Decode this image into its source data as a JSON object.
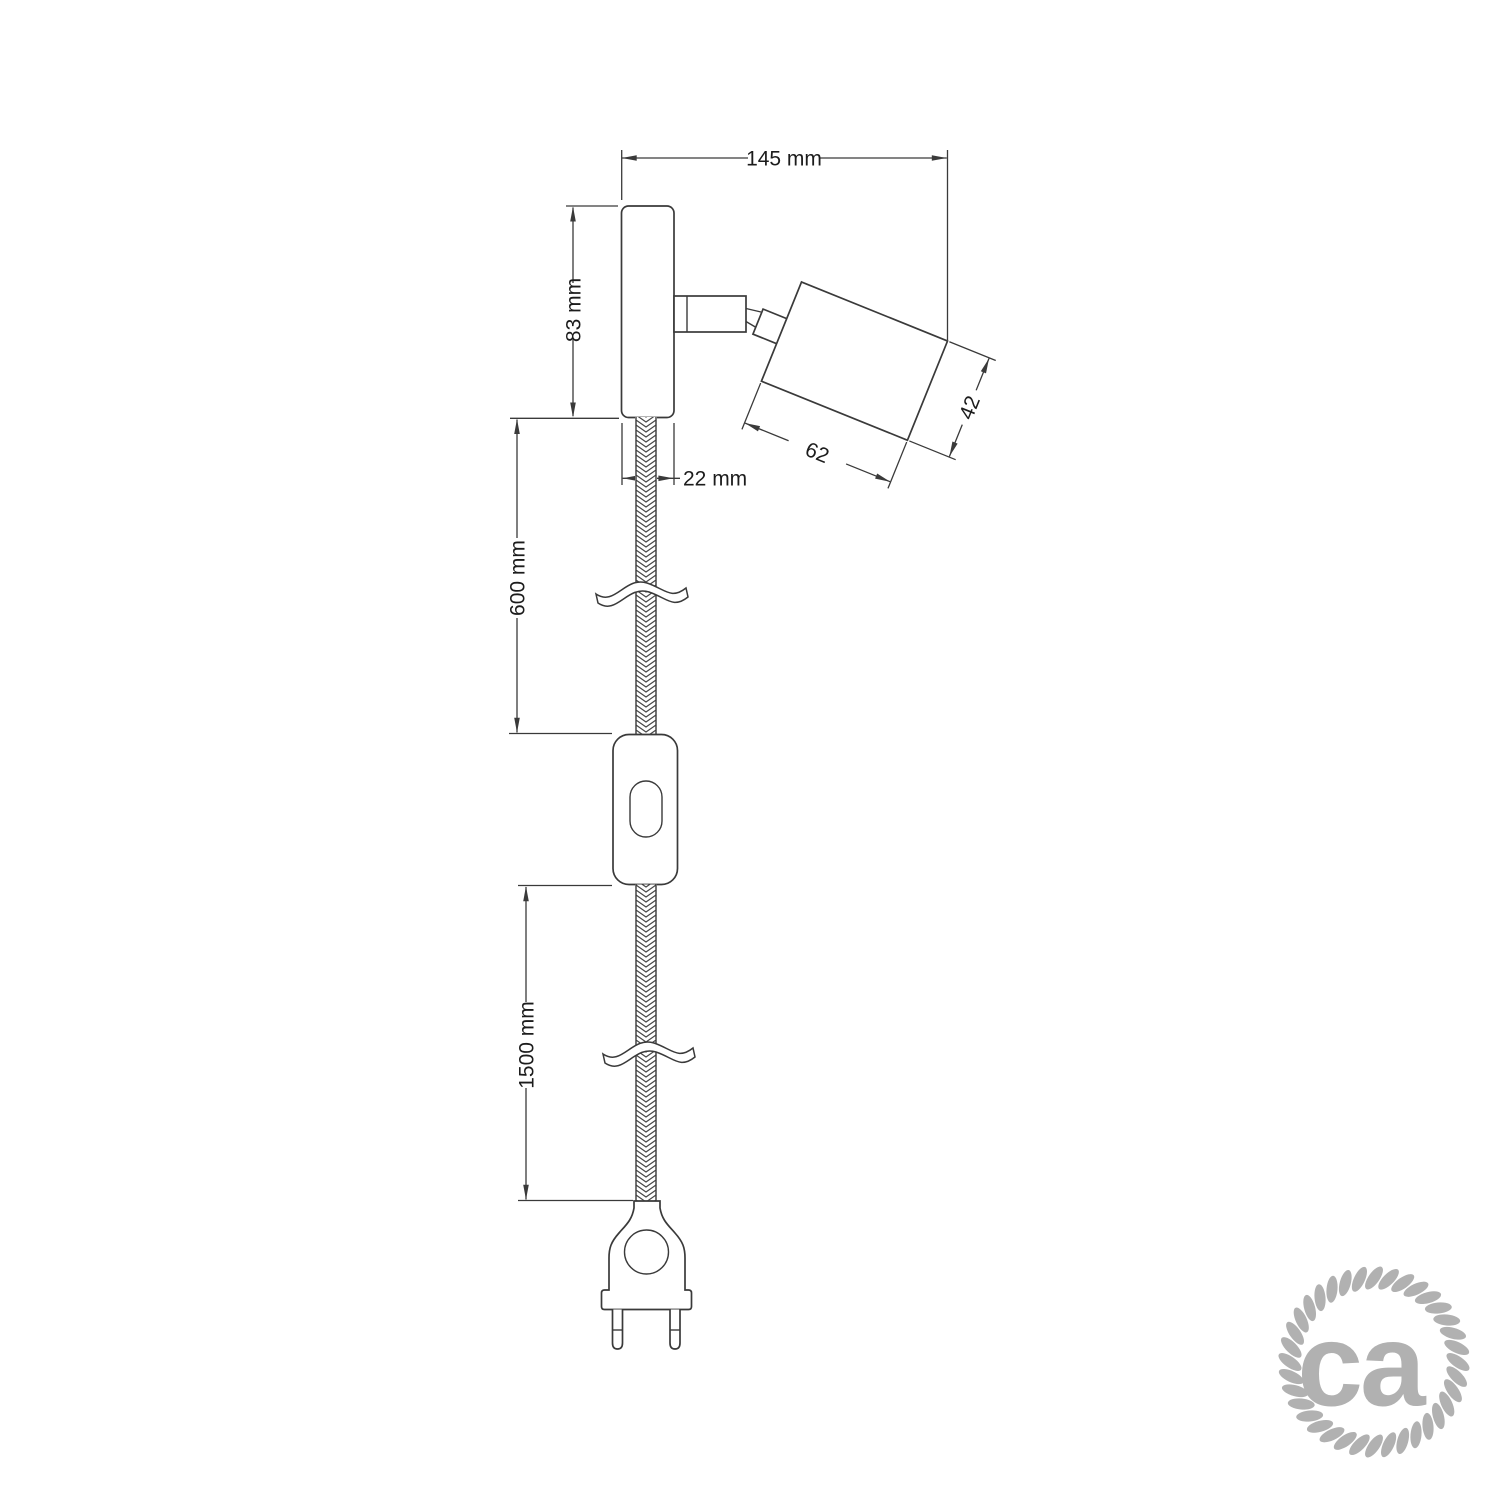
{
  "labels": {
    "width": "145 mm",
    "height": "83 mm",
    "depth": "22 mm",
    "cable_upper": "600 mm",
    "cable_lower": "1500 mm",
    "spot_length": "62",
    "spot_diameter": "42"
  },
  "logo": {
    "text": "ca"
  },
  "colors": {
    "line": "#3a3a3a",
    "text": "#1c1c1c",
    "logo": "#b1b1b1",
    "background": "#ffffff"
  }
}
